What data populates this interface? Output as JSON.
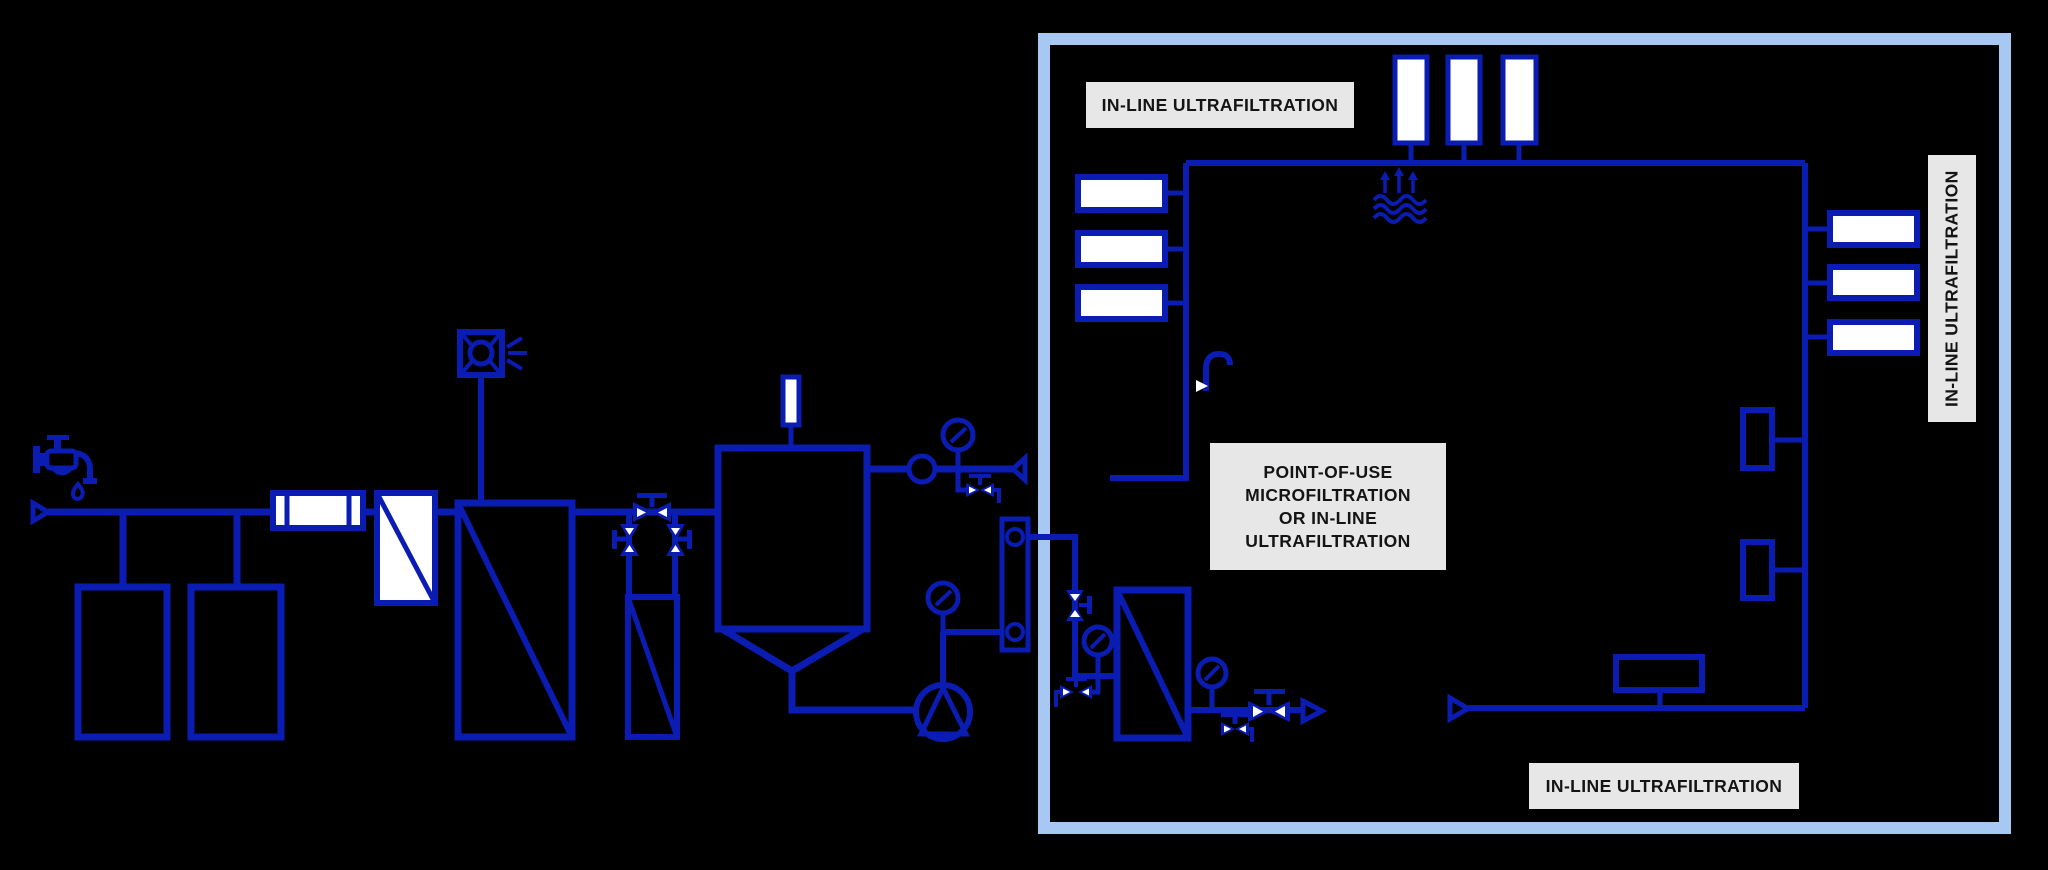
{
  "diagram": {
    "description_labels": {
      "inline_uf_top": "IN-LINE ULTRAFILTRATION",
      "point_of_use": {
        "line1": "POINT-OF-USE",
        "line2": "MICROFILTRATION",
        "line3": "OR IN-LINE",
        "line4": "ULTRAFILTRATION"
      },
      "inline_uf_right": "IN-LINE ULTRAFILTRATION",
      "inline_uf_bottom": "IN-LINE ULTRAFILTRATION"
    },
    "colors": {
      "background": "#000000",
      "line": "#0a1cb2",
      "box_border": "#a6c8f2",
      "label_bg": "#e7e7e7",
      "label_text": "#141414",
      "equipment_fill_white": "#ffffff"
    },
    "icons": [
      "water-tap-icon",
      "water-drop-icon",
      "flow-arrow-icon",
      "uv-lamp-icon",
      "pressure-gauge-icon",
      "flow-indicator-icon",
      "gate-valve-icon",
      "drain-valve-icon",
      "pump-icon",
      "rotameter-icon",
      "evaporation-icon",
      "tap-outlet-icon",
      "filter-module-icon"
    ]
  }
}
